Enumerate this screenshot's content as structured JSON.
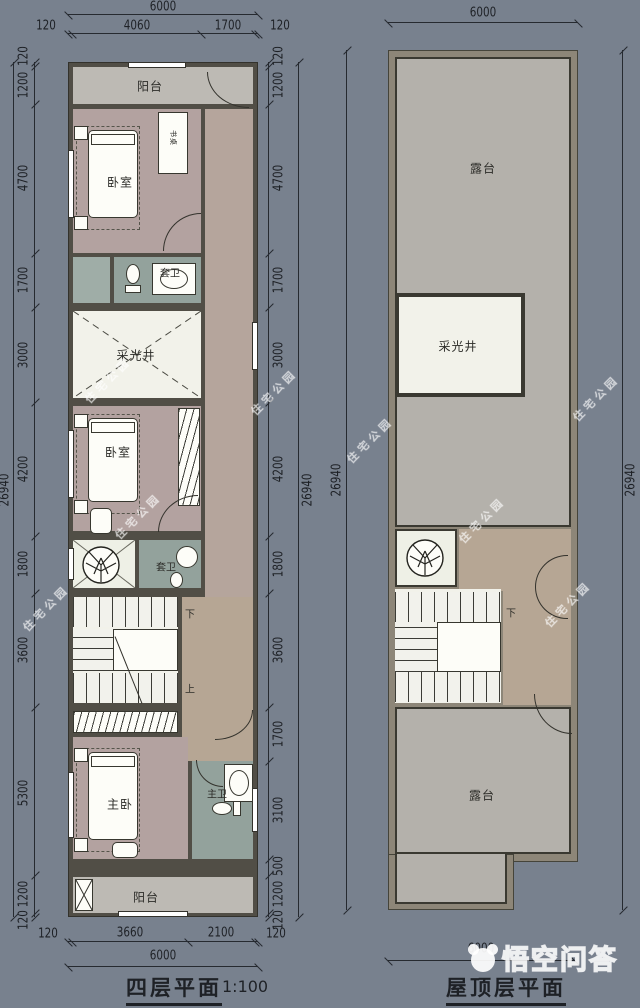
{
  "left_plan": {
    "title": "四层平面",
    "scale_note": "1:100",
    "rooms": {
      "balcony_top": "阳台",
      "bedroom_top": "卧室",
      "desk": "书桌",
      "bath_top": "套卫",
      "lightwell": "采光井",
      "bedroom_mid": "卧室",
      "bath_mid": "套卫",
      "master": "主卧",
      "master_bath": "主卫",
      "balcony_bottom": "阳台"
    },
    "stairs": {
      "down": "下",
      "up": "上"
    },
    "dims": {
      "top_total": "6000",
      "top_segments": [
        "120",
        "4060",
        "1700",
        "120"
      ],
      "bottom_segments": [
        "120",
        "3660",
        "2100",
        "120"
      ],
      "bottom_total": "6000",
      "left_segments": [
        "120",
        "1200",
        "4700",
        "1700",
        "3000",
        "4200",
        "1800",
        "3600",
        "5300",
        "1200",
        "120"
      ],
      "left_total": "26940",
      "right_segments": [
        "120",
        "1200",
        "4700",
        "1700",
        "3000",
        "4200",
        "1800",
        "3600",
        "1700",
        "3100",
        "500",
        "1200",
        "120"
      ],
      "right_total": "26940"
    }
  },
  "right_plan": {
    "title": "屋顶层平面",
    "rooms": {
      "terrace_top": "露台",
      "lightwell": "采光井",
      "terrace_bottom": "露台"
    },
    "stairs": {
      "down": "下"
    },
    "dims": {
      "top_total": "6000",
      "bottom_total": "6000",
      "left_total": "26940",
      "right_total": "26940"
    }
  },
  "watermarks": {
    "site": "住宅公园",
    "brand": "悟空问答"
  }
}
